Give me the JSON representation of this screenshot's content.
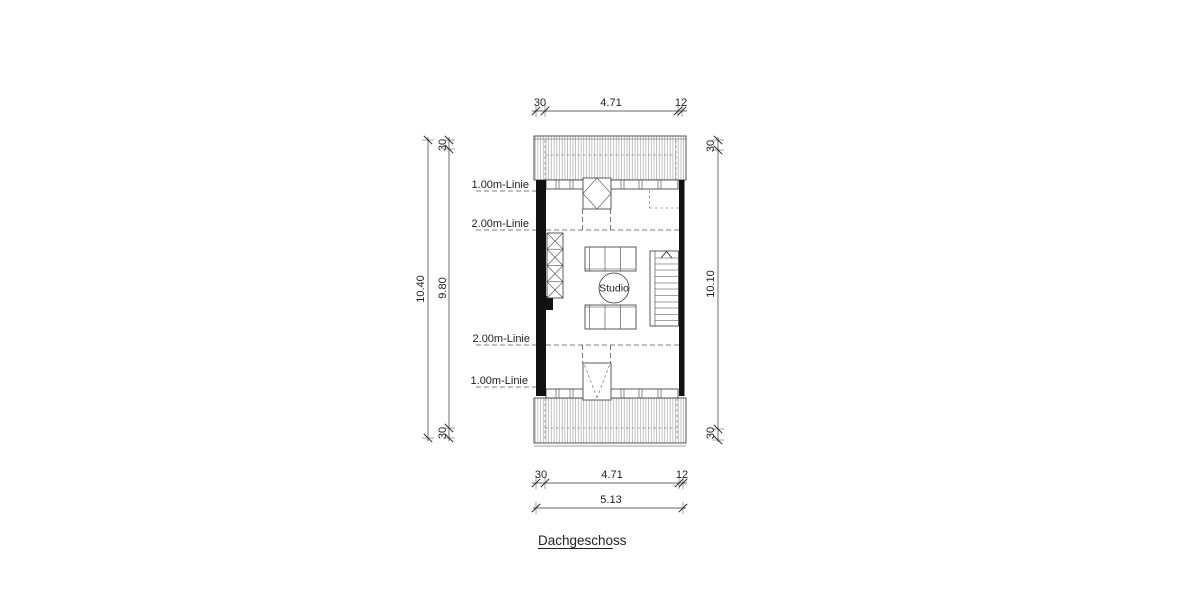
{
  "drawing": {
    "title": "Dachgeschoss",
    "room_label": "Studio",
    "height_lines": {
      "top_1m": "1.00m-Linie",
      "top_2m": "2.00m-Linie",
      "bottom_2m": "2.00m-Linie",
      "bottom_1m": "1.00m-Linie"
    },
    "dims": {
      "top": {
        "left_wall": "30",
        "interior": "4.71",
        "right_wall": "12"
      },
      "bottom": {
        "left_wall": "30",
        "interior": "4.71",
        "right_wall": "12",
        "total": "5.13"
      },
      "left": {
        "total": "10.40",
        "offset_top": "30",
        "interior": "9.80",
        "offset_bottom": "30"
      },
      "right": {
        "offset_top": "30",
        "interior": "10.10",
        "offset_bottom": "30"
      }
    }
  }
}
